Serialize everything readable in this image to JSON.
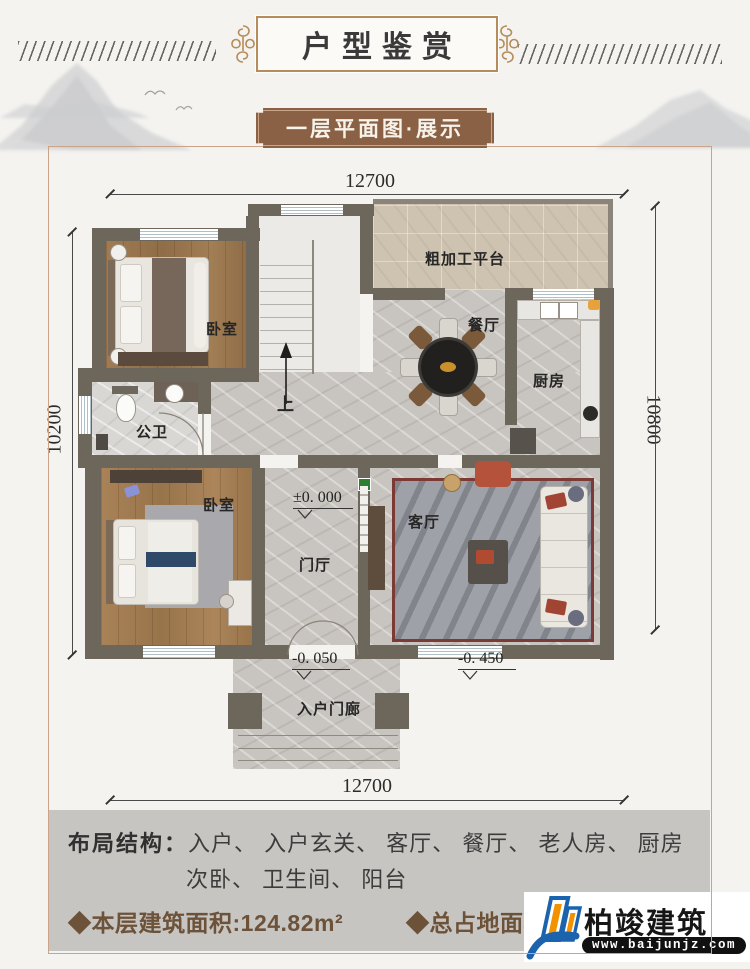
{
  "header": {
    "title": "户型鉴赏",
    "banner": "一层平面图·展示"
  },
  "plan": {
    "dims": {
      "top": "12700",
      "bottom": "12700",
      "left": "10200",
      "right": "10800"
    },
    "rooms": {
      "bed1": "卧室",
      "bath": "公卫",
      "stairs": "上",
      "platform": "粗加工平台",
      "dining": "餐厅",
      "kitchen": "厨房",
      "bed2": "卧室",
      "foyer": "门厅",
      "living": "客厅",
      "porch": "入户门廊"
    },
    "elev": {
      "e0": "±0. 000",
      "e1": "-0. 050",
      "e2": "-0. 450"
    }
  },
  "footer": {
    "layout_label": "布局结构：",
    "layout_line1": "入户、 入户玄关、 客厅、 餐厅、 老人房、 厨房",
    "layout_line2": "次卧、 卫生间、 阳台",
    "bullet1": "◆",
    "stat1": "本层建筑面积:124.82m²",
    "bullet2": "◆",
    "stat2": "总占地面积:"
  },
  "logo": {
    "name": "柏竣建筑",
    "url": "www.baijunjz.com"
  },
  "colors": {
    "accent_gold": "#b68d5a",
    "banner_brown": "#8a6145",
    "wall": "#6c665b",
    "panel_gray": "#c6c5c2",
    "stat_brown": "#6d523a",
    "logo_blue": "#1c63ad",
    "logo_orange": "#f29200"
  }
}
